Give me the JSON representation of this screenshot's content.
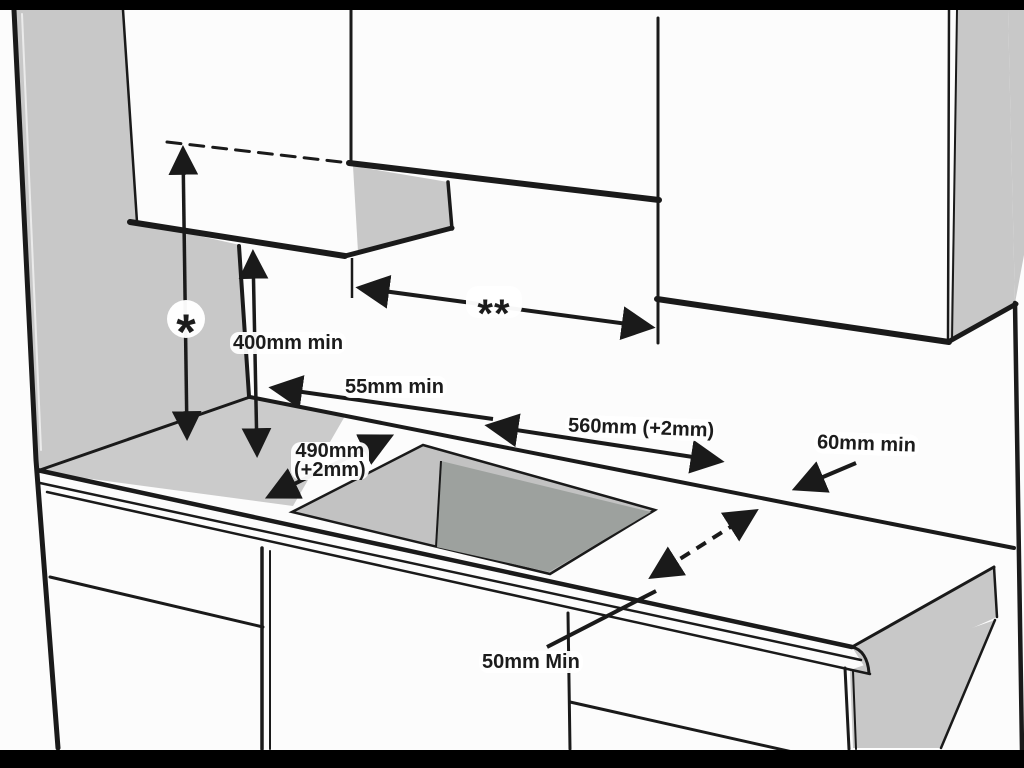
{
  "diagram": {
    "title": "hob-installation-clearance-diagram",
    "labels": {
      "asterisk": "*",
      "double_asterisk": "**",
      "height_min": "400mm min",
      "rear_min": "55mm min",
      "cutout_width": "560mm (+2mm)",
      "cutout_depth_l1": "490mm",
      "cutout_depth_l2": "(+2mm)",
      "side_min": "60mm min",
      "front_min": "50mm Min"
    },
    "colors": {
      "line": "#1a1a1a",
      "wall_shade": "#c8c8c8",
      "counter_shade": "#cbcbcb",
      "cutout_inner": "#c2c2c2",
      "cutout_bottom": "#9da19e",
      "paper": "#fcfcfc",
      "border_bar": "#000000"
    }
  }
}
